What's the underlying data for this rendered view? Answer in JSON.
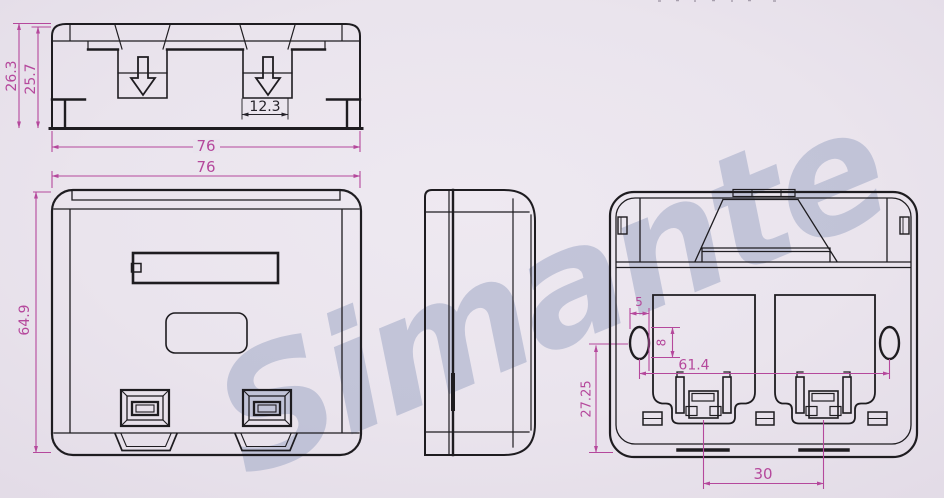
{
  "watermark": {
    "text": "Simante"
  },
  "colors": {
    "background": "#eae4ed",
    "line": "#1e1c20",
    "dimension": "#b5489c",
    "watermark": "#a9b0cb"
  },
  "views": {
    "top_view": {
      "dimensions": {
        "overall_depth": "26.3",
        "body_depth": "25.7",
        "overall_width": "76",
        "slot_width": "12.3"
      }
    },
    "front_view": {
      "dimensions": {
        "overall_width": "76",
        "overall_height": "64.9"
      }
    },
    "side_view": {
      "dimensions": {
        "port_center_height": "27.25"
      }
    },
    "back_view": {
      "dimensions": {
        "screw_slot_width": "5",
        "screw_slot_length": "8",
        "screw_hole_spacing": "61.4",
        "latch_spacing": "30"
      }
    }
  }
}
